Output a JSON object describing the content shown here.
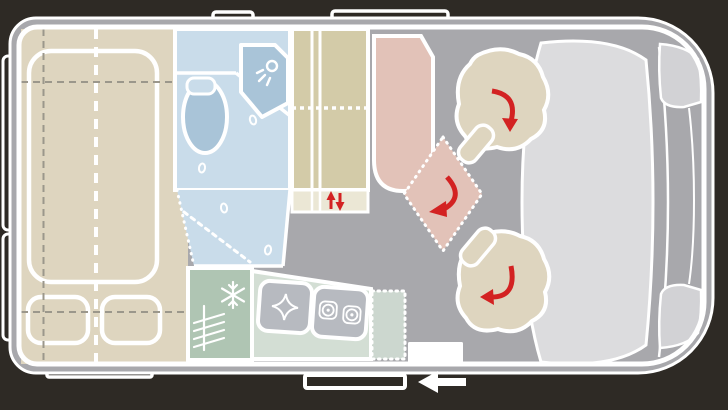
{
  "meta": {
    "title": "Campervan floor plan (top view)",
    "canvas": {
      "width": 728,
      "height": 410
    },
    "orientation": "vehicle front on the right, travel direction arrow points left"
  },
  "palette": {
    "bg": "#2e2a25",
    "floor": "#a8a8ac",
    "white": "#ffffff",
    "beige": "#ded5bf",
    "olive": "#d3cba8",
    "oliveLight": "#ebe7d5",
    "blue": "#c9dcea",
    "blueDark": "#a9c4d8",
    "pink": "#e2c2b8",
    "green": "#afc5b3",
    "mint": "#d3ded4",
    "mint2": "#ccd7cf",
    "unit": "#b7bac0",
    "light": "#dcdcde",
    "lightMid": "#d2d2d5",
    "red": "#d32222",
    "dash": "#9b978b"
  },
  "zones": {
    "bed": {
      "label": "rear longitudinal bed with two pillows",
      "fill": "beige"
    },
    "bathroom": {
      "label": "washroom with toilet, shower cubicle and shower tray",
      "fill": "blue"
    },
    "wardrobe": {
      "label": "wardrobe / cabinet column with lift element",
      "fill": "olive"
    },
    "dinette": {
      "label": "bench seat with swivel table position (dashed)",
      "fill": "pink"
    },
    "kitchen": {
      "label": "kitchen block: fridge, sink, two-burner hob, worktop flap",
      "fill": "green"
    },
    "cab": {
      "label": "driver cab with two swivel seats and dashboard",
      "fill": "light"
    },
    "entry": {
      "label": "entry step and sliding-door rail",
      "fill": "white"
    }
  },
  "icons": [
    "snowflake-icon",
    "shower-head-icon",
    "sink-icon",
    "burner-icon",
    "rotation-arrow-icon",
    "up-down-arrow-icon",
    "travel-direction-arrow-icon",
    "drain-icon"
  ],
  "indicators": {
    "swivel_seats": 2,
    "rotating_table_positions": 2,
    "lift_arrows": "up/down",
    "travel_direction": "left"
  }
}
